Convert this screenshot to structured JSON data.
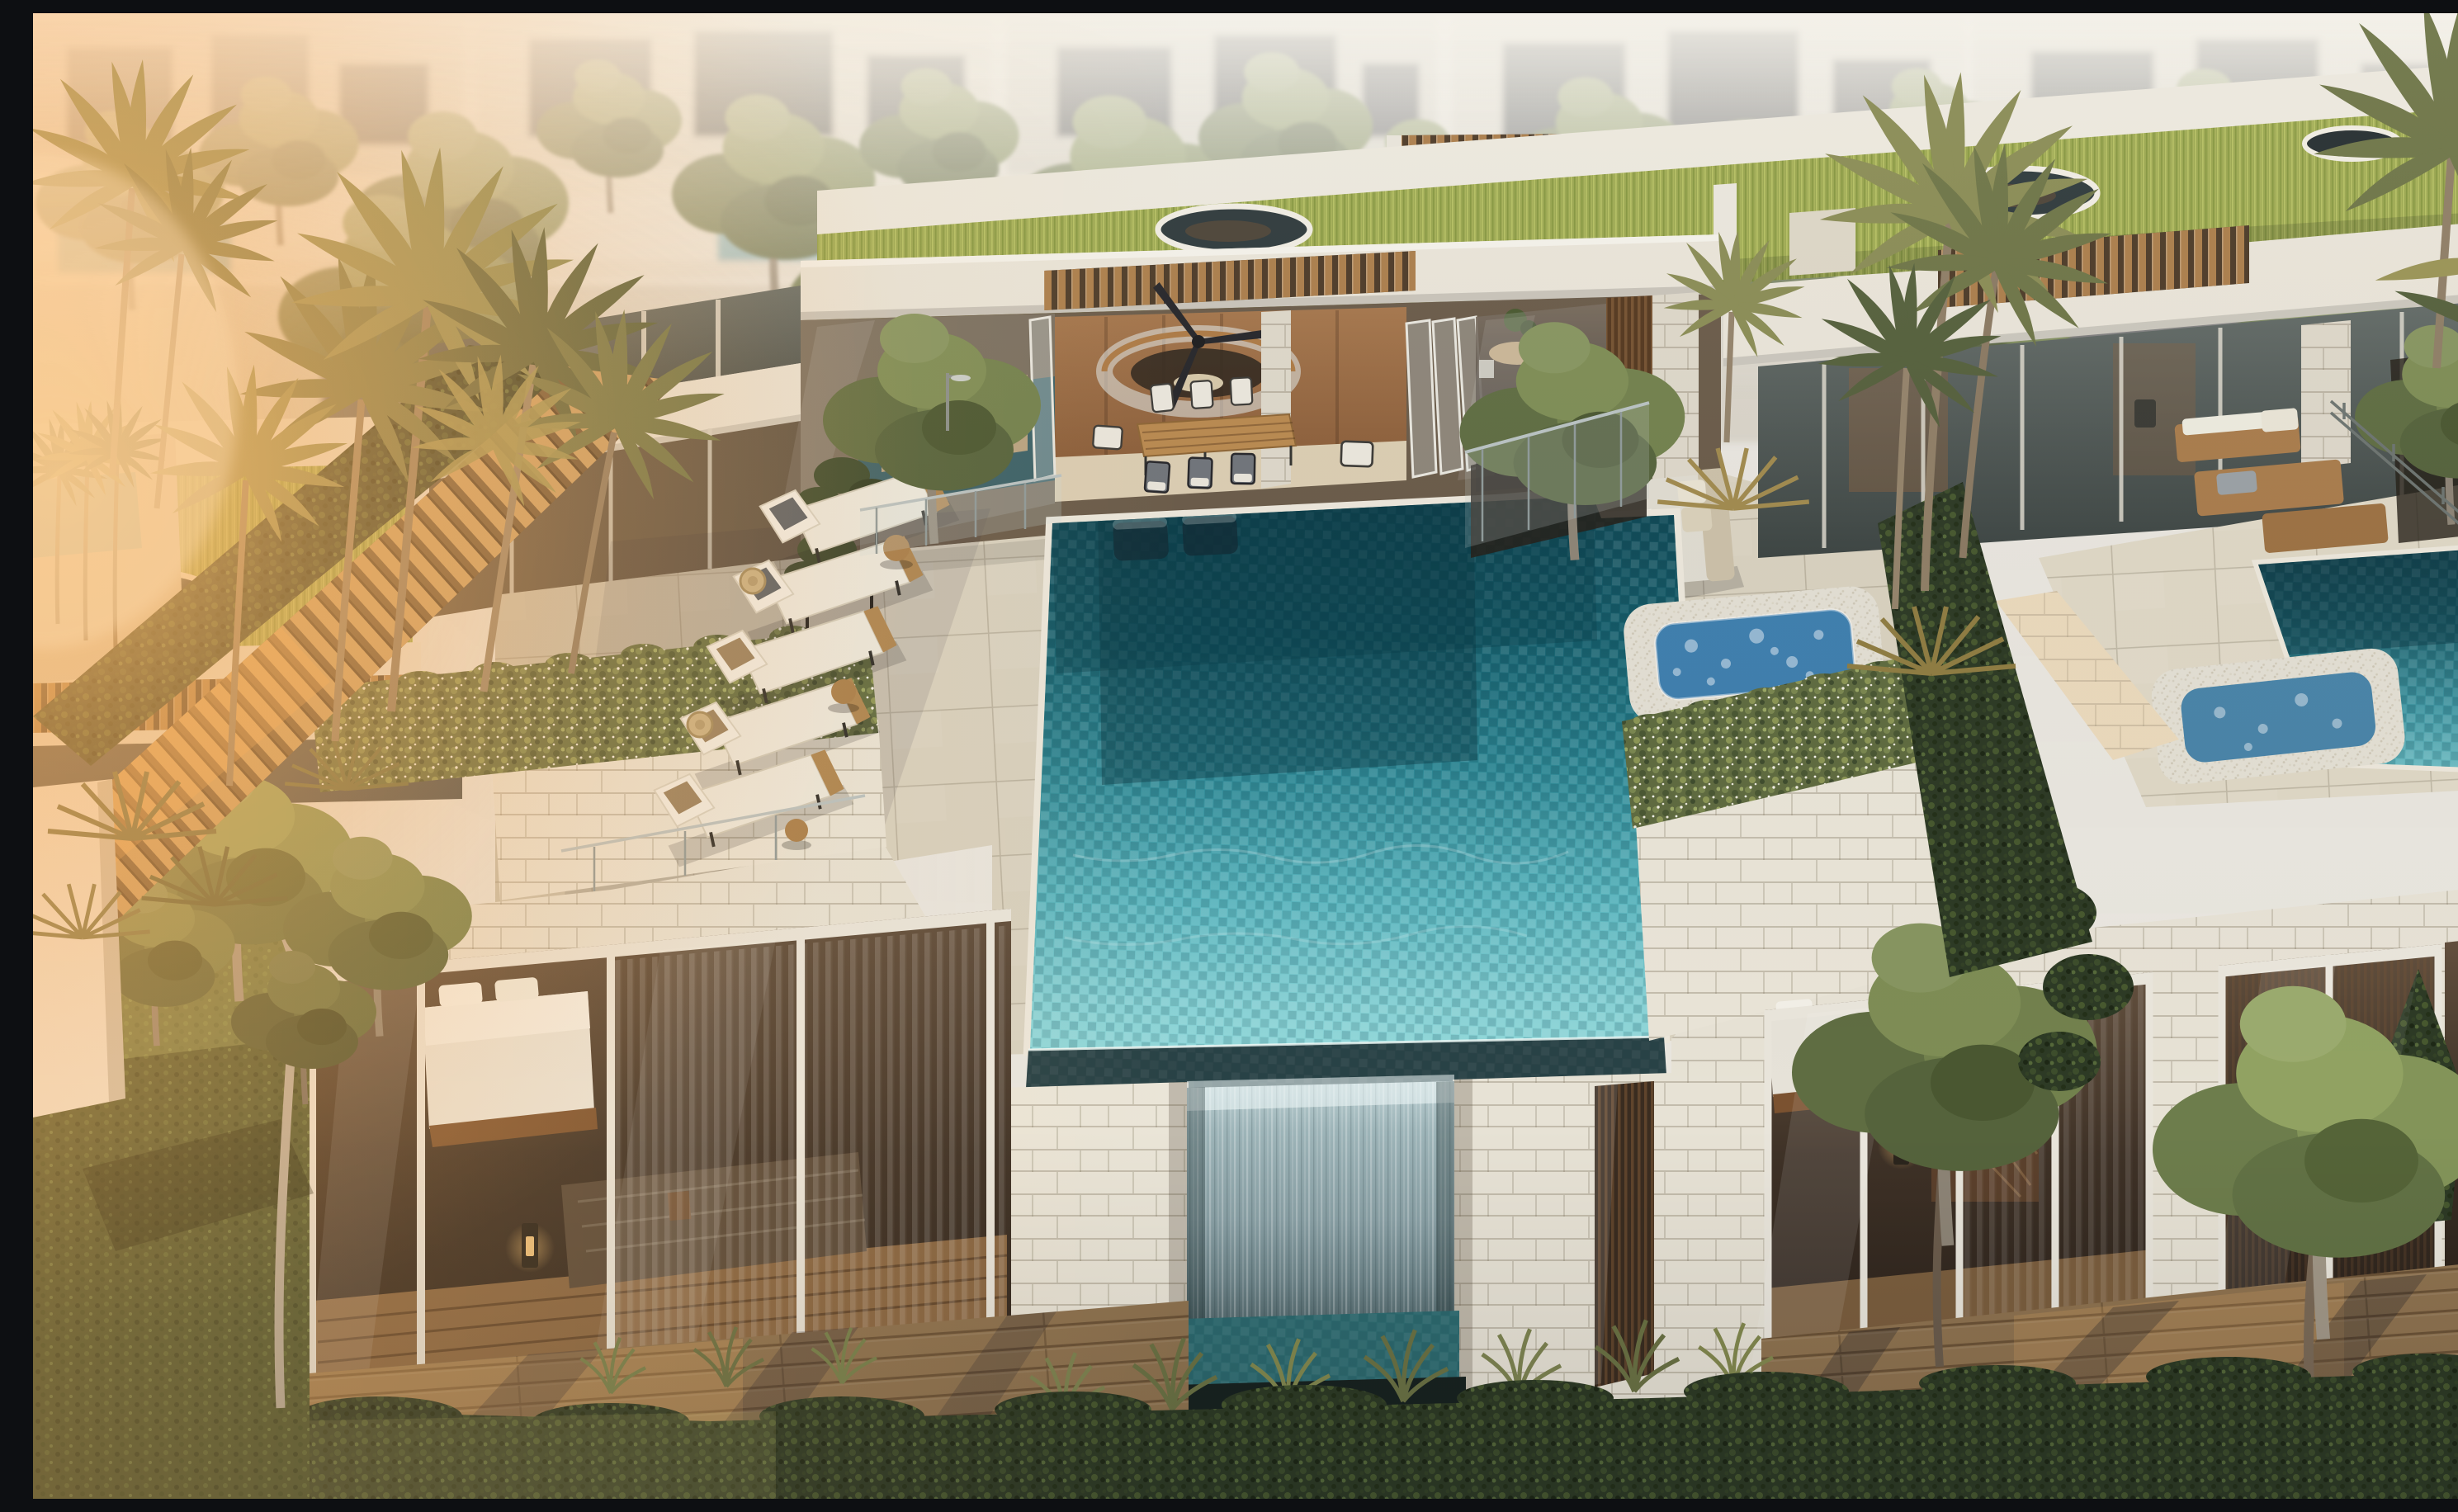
{
  "meta": {
    "type": "photorealistic-architectural-rendering",
    "alt": "Aerial late-afternoon rendering of a modern luxury villa rooftop terrace: a turquoise mosaic infinity pool with a waterfall edge spilling over a white stone wall, a row of sun loungers, an open dining pavilion with ceiling fan and circular glass balustrade, a bubbling spa pool, flowering planters, palm trees, grass-covered green roofs with circular skylights, bedroom glass walls below, and neighbouring villas with their own pools behind, warm sun flare from the left"
  },
  "palette": {
    "haze": "#e9e6df",
    "stone": "#e9e4d8",
    "stone_shadow": "#cfc8b8",
    "grass_roof": "#9aa64f",
    "terrace": "#d8d1bf",
    "pool_deep": "#0e4350",
    "pool_mid": "#2d8794",
    "pool_light": "#8ed7d9",
    "pool_edge_dark": "#2a4347",
    "waterfall": "#8aa1a6",
    "jacuzzi": "#3f7fae",
    "wood": "#b5854f",
    "deck": "#8f7350",
    "hedge": "#2d3a25",
    "lawn": "#4c5731",
    "palm": "#6e7547",
    "interior_wood": "#8a5d39",
    "cushion": "#ece9df",
    "pillow": "#5a6066",
    "sun_glow": "#ffb763"
  },
  "scene": {
    "objects": {
      "pool": {
        "label": "Infinity mosaic pool"
      },
      "waterfall": {
        "label": "Waterfall edge over stone wall"
      },
      "jacuzzi": {
        "label": "Bubbling spa pool"
      },
      "sun_loungers": {
        "label": "Sun loungers",
        "count": 5
      },
      "in_pool_loungers": {
        "label": "Submerged wet-deck loungers",
        "count": 2
      },
      "side_tables": {
        "label": "Round teak side tables",
        "count": 3
      },
      "dining_set": {
        "label": "Outdoor teak dining table",
        "chairs": 8
      },
      "daybed": {
        "label": "Poolside daybed with towel"
      },
      "sunken_lounge": {
        "label": "Sunken lounge ringed by water"
      },
      "ceiling_fan": {
        "label": "Black ceiling fan"
      },
      "circular_balustrade": {
        "label": "Curved glass stair balustrade"
      },
      "green_roofs": {
        "label": "Grass roofs",
        "count": 3,
        "skylights": 4
      },
      "pergolas": {
        "label": "Timber slat pergolas",
        "count": 4
      },
      "palms": {
        "label": "Palm trees"
      },
      "planters": {
        "label": "Flowering trailing planters"
      },
      "bedrooms": {
        "label": "Glazed bedrooms below terrace",
        "count": 2
      },
      "decks": {
        "label": "Timber decks",
        "count": 2
      },
      "bollard_lights": {
        "label": "Glowing bollard lights",
        "count": 3
      },
      "front_hedge": {
        "label": "Clipped boundary hedge"
      },
      "timber_fence": {
        "label": "Slatted timber privacy fence"
      },
      "outdoor_shower": {
        "label": "Pool shower"
      },
      "neighbor_pool": {
        "label": "Neighbouring villa pool"
      },
      "neighbor_jacuzzi": {
        "label": "Neighbouring villa spa"
      },
      "neighbor_furniture": {
        "label": "Teak lounge furniture"
      },
      "sun_flare": {
        "label": "Warm sun flare from the left"
      }
    }
  }
}
